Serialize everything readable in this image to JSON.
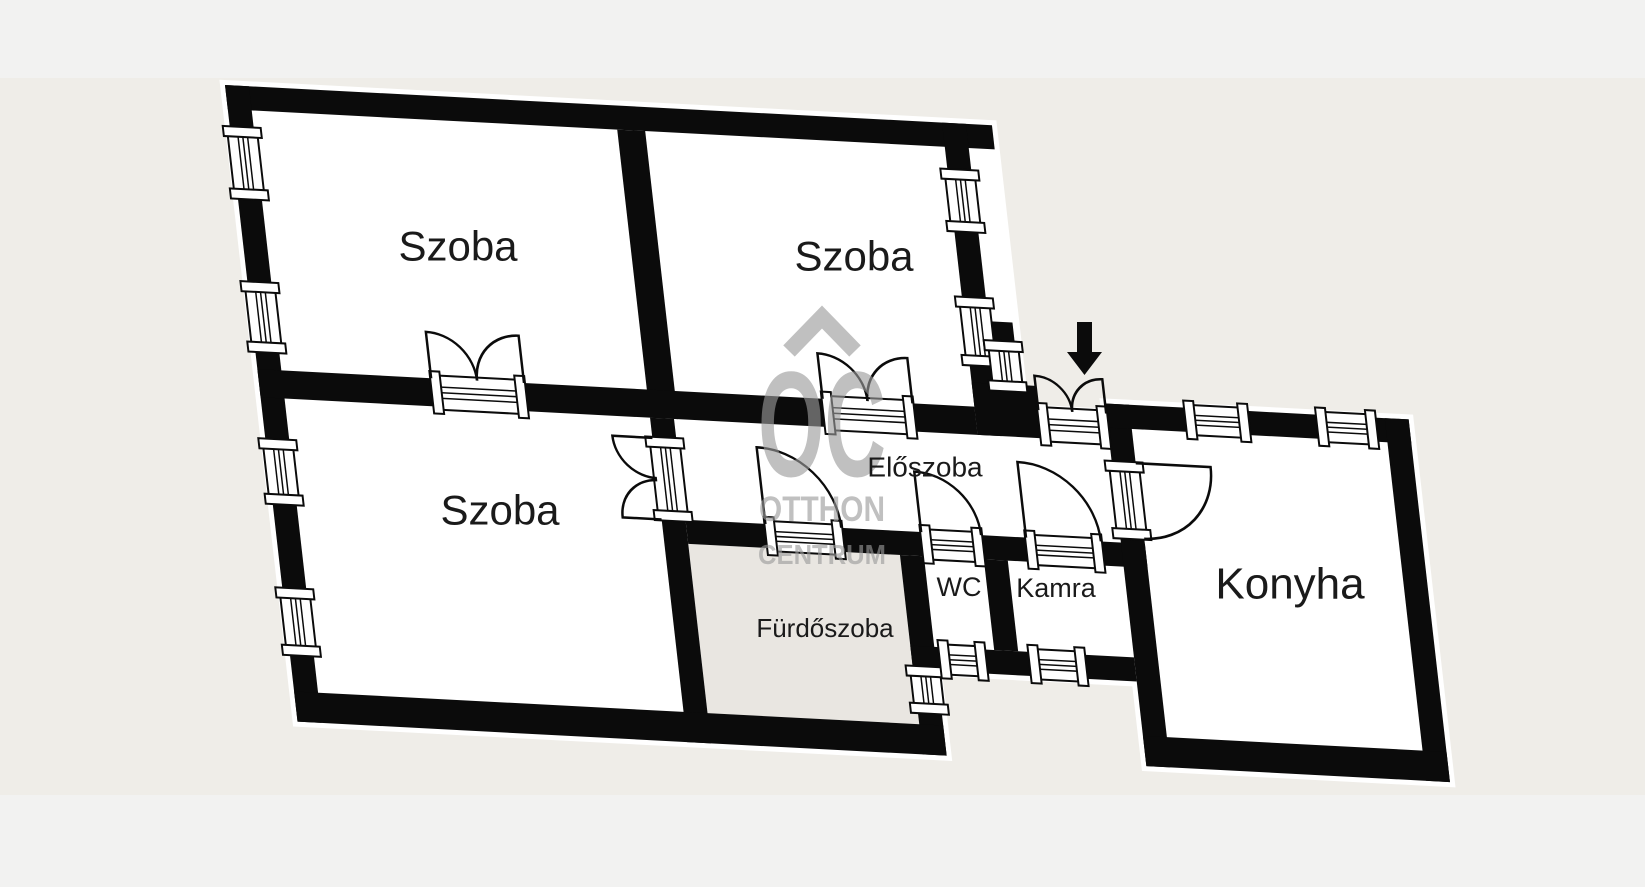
{
  "colors": {
    "page_background": "#f2f2f1",
    "photo_background": "#efede8",
    "wall": "#0b0b0b",
    "room_fill": "#ffffff",
    "bathroom_fill": "#e9e6e1",
    "label_text": "#1a1a1a",
    "watermark": "#9b9b9b"
  },
  "rooms": [
    {
      "id": "szoba-top-left",
      "label": "Szoba"
    },
    {
      "id": "szoba-top-right",
      "label": "Szoba"
    },
    {
      "id": "szoba-bottom-left",
      "label": "Szoba"
    },
    {
      "id": "eloszoba",
      "label": "Előszoba"
    },
    {
      "id": "wc",
      "label": "WC"
    },
    {
      "id": "kamra",
      "label": "Kamra"
    },
    {
      "id": "furdoszoba",
      "label": "Fürdőszoba"
    },
    {
      "id": "konyha",
      "label": "Konyha"
    }
  ],
  "watermark": {
    "roof_icon": "house-roof",
    "monogram": "OC",
    "line1": "OTTHON",
    "line2": "CENTRUM"
  },
  "entrance": {
    "marker_icon": "arrow-down"
  }
}
